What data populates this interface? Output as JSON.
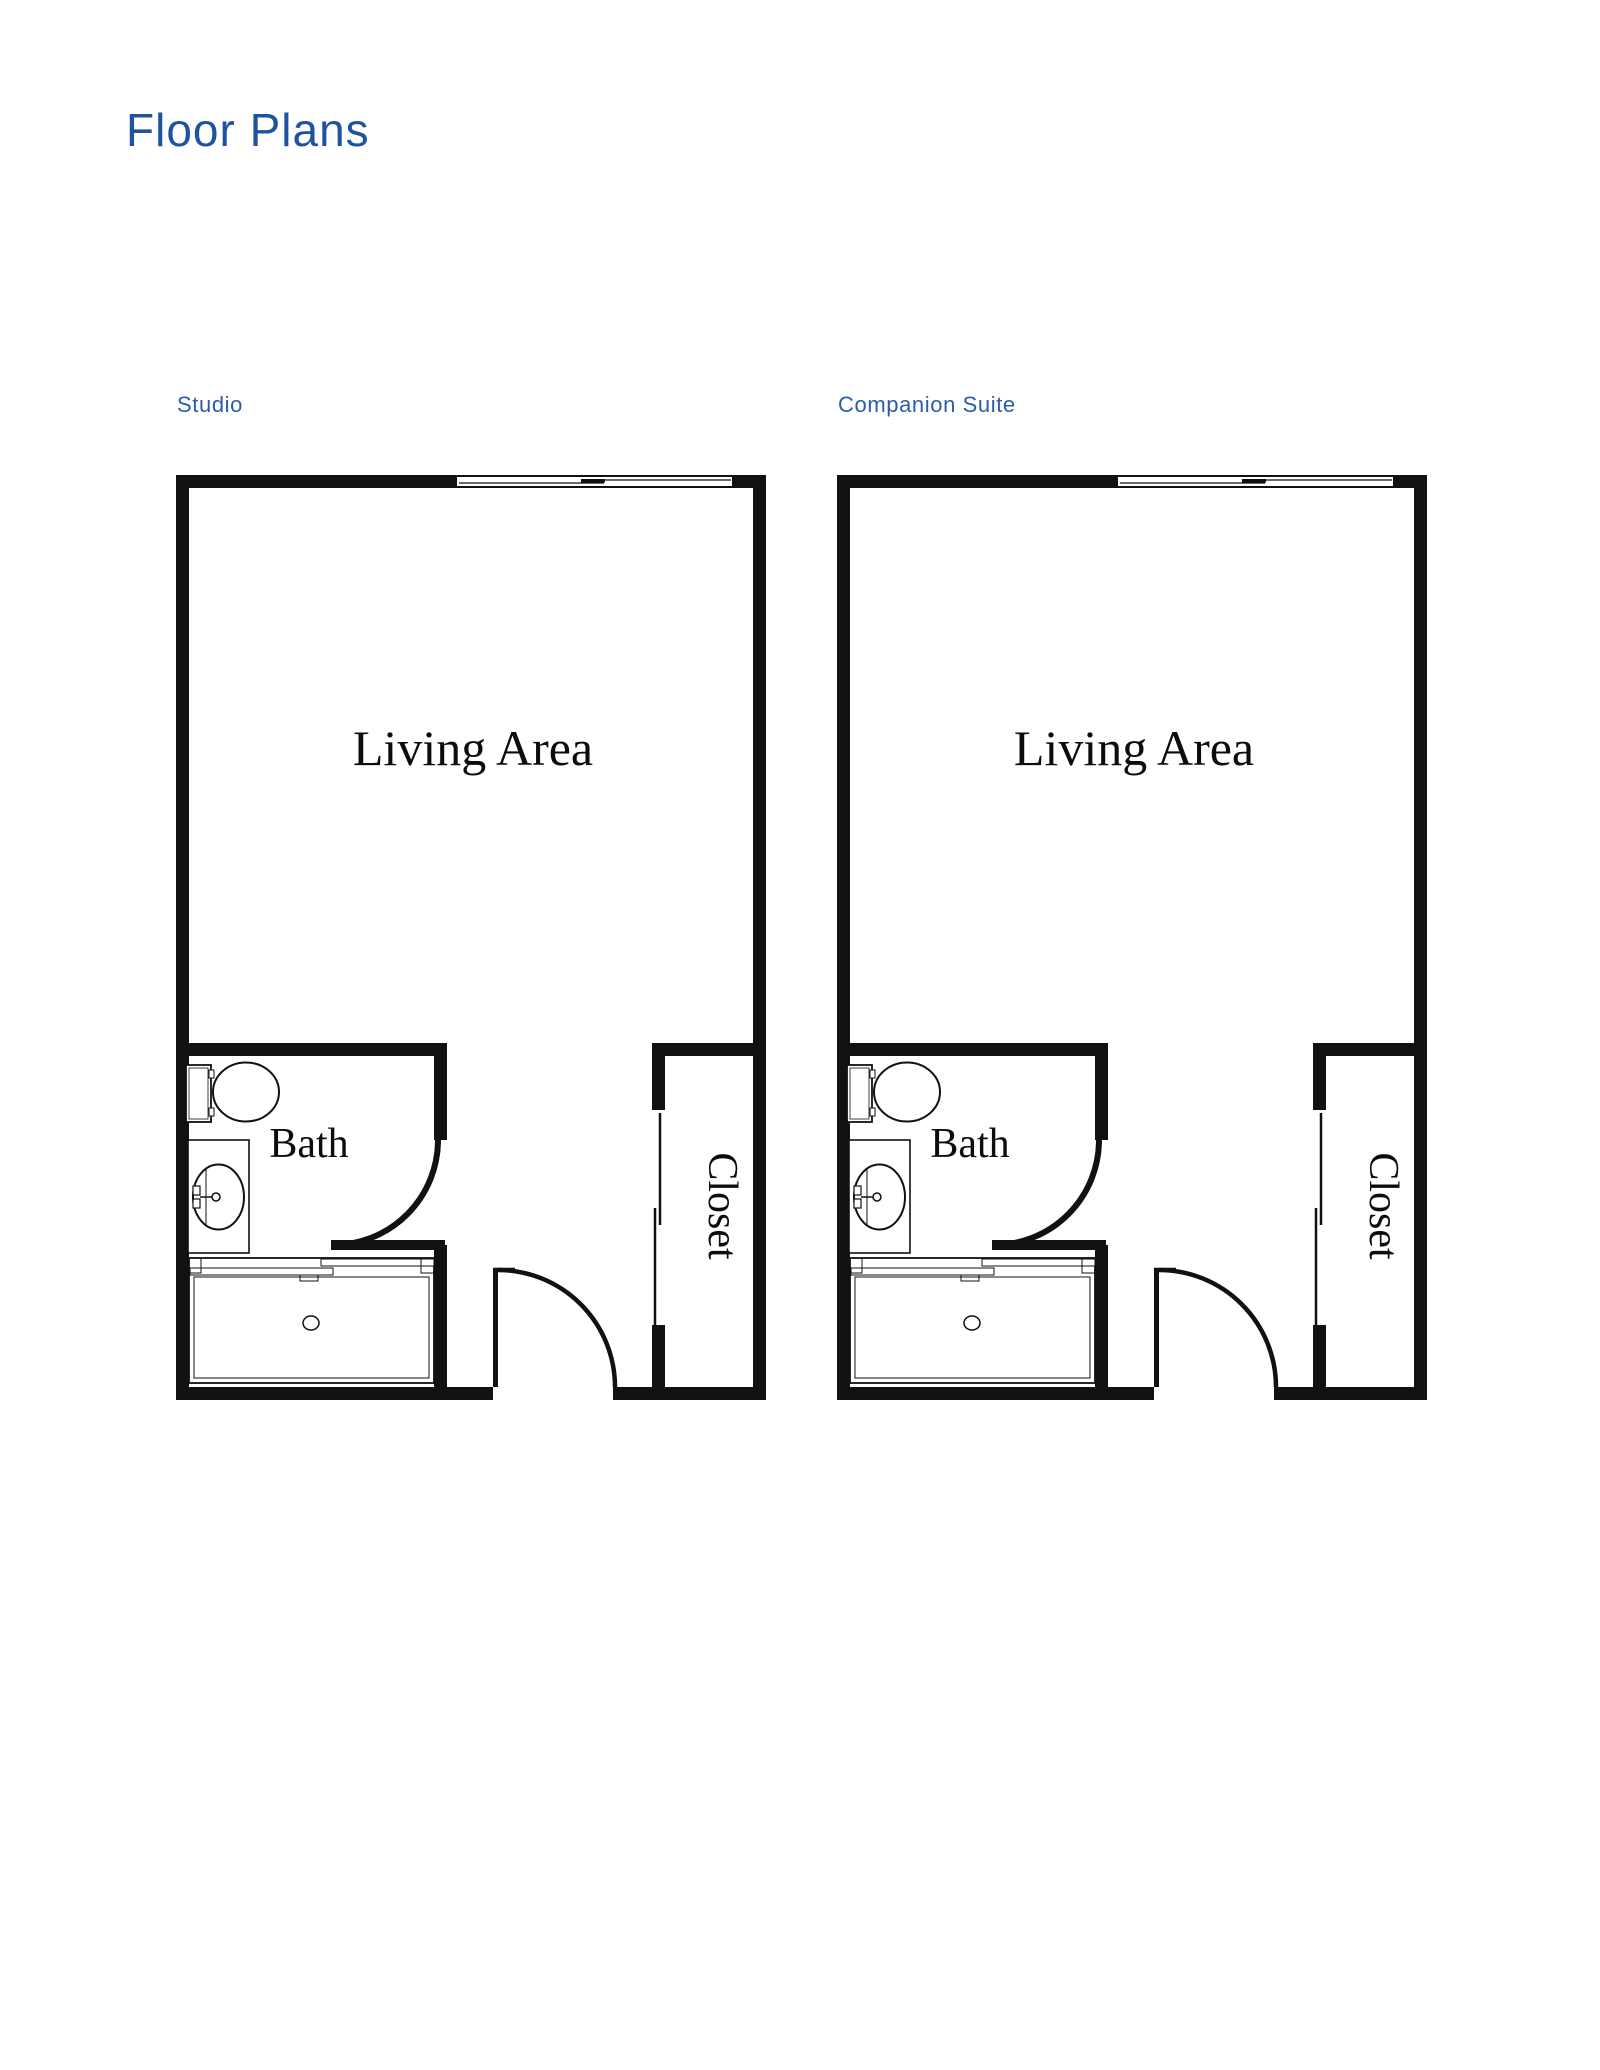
{
  "page": {
    "title": "Floor Plans"
  },
  "colors": {
    "accent-heading": "#1e549f",
    "accent-label": "#2e5ca6",
    "line": "#111111"
  },
  "plans": [
    {
      "label": "Studio",
      "rooms": {
        "living": "Living Area",
        "bath": "Bath",
        "closet": "Closet"
      }
    },
    {
      "label": "Companion Suite",
      "rooms": {
        "living": "Living Area",
        "bath": "Bath",
        "closet": "Closet"
      }
    }
  ]
}
